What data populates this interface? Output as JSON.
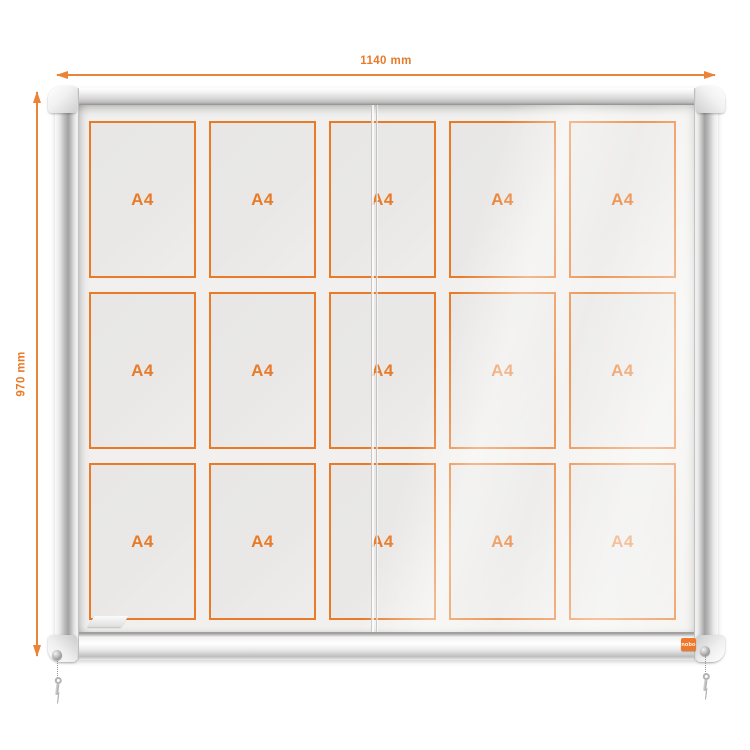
{
  "annotations": {
    "width_label": "1140 mm",
    "height_label": "970 mm"
  },
  "case": {
    "badge_label": "nobo"
  },
  "grid": {
    "rows": 3,
    "cols": 5,
    "cell_label": "A4"
  },
  "colors": {
    "accent": "#e87a28",
    "badge": "#f0782a",
    "glass": "#f1f0ee",
    "cell_fill": "#e9e8e6",
    "frame_light": "#f7f7f7",
    "frame_mid": "#c9c9c9",
    "frame_dark": "#9a9a9a"
  }
}
